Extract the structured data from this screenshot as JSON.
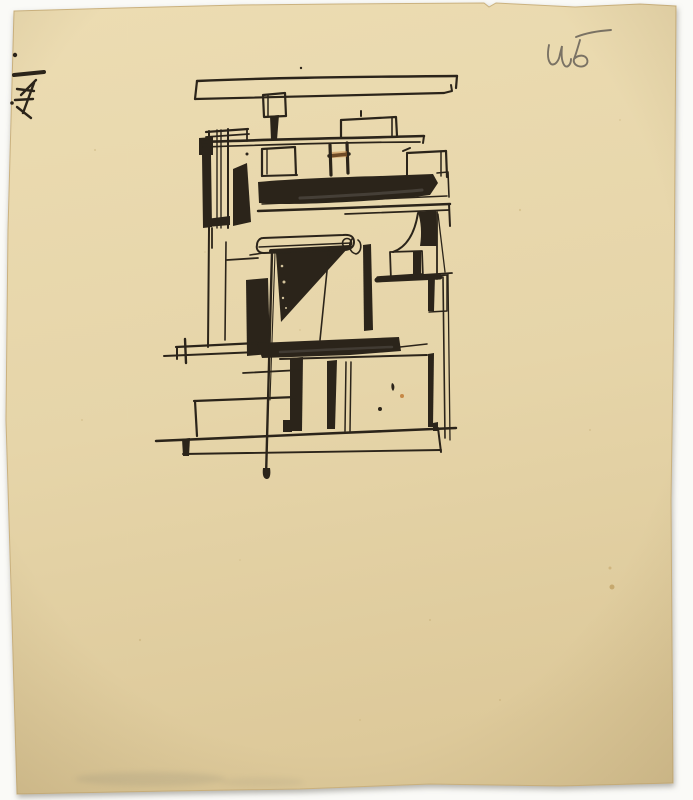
{
  "document": {
    "type": "scanned ink sketch on aged paper",
    "subject": "Hand-drawn constructivist architectural study of a building facade, black ink on yellowed torn-edge paper",
    "handwriting": {
      "text": "ч5",
      "position": "top-right",
      "medium": "pencil"
    },
    "corner_mark": {
      "description": "small ink scribble notation",
      "position": "top-left"
    }
  },
  "colors": {
    "backdrop": "#fafaf7",
    "paper_light": "#ecdcb2",
    "paper_mid": "#e6d5a9",
    "paper_dark": "#ddc99a",
    "paper_rim": "#cbb27f",
    "ink": "#2b241a",
    "ink_wash": "#57514b",
    "rust": "#c07a35",
    "stain": "#b08a45",
    "freckle": "#b49756",
    "smudge": "#8f8a76",
    "pencil": "#6e675c"
  }
}
